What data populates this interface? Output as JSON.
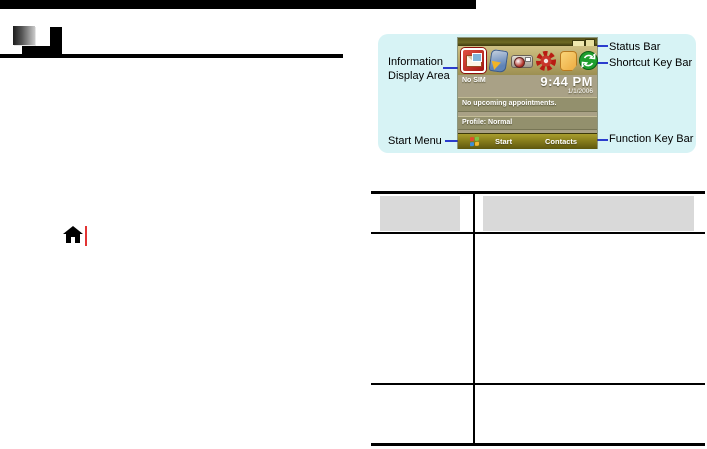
{
  "annotations": {
    "left": [
      {
        "text": "Information Display Area"
      },
      {
        "text": "Start Menu"
      }
    ],
    "right": [
      {
        "text": "Status Bar"
      },
      {
        "text": "Shortcut Key Bar"
      },
      {
        "text": "Function Key Bar"
      }
    ]
  },
  "phone": {
    "status_icons": [
      "battery-icon",
      "sim-icon"
    ],
    "shortcut_icons": [
      "messaging-icon",
      "phone-icon",
      "camera-icon",
      "settings-icon",
      "notes-icon",
      "activesync-icon"
    ],
    "no_sim": "No SIM",
    "time": "9:44 PM",
    "date": "1/1/2006",
    "appointments": "No upcoming appointments.",
    "profile": "Profile: Normal",
    "softkeys": {
      "left": "Start",
      "right": "Contacts"
    }
  },
  "table": {
    "columns": 2,
    "header_cells": [
      "",
      ""
    ],
    "body_rows": [
      [
        "",
        ""
      ],
      [
        "",
        ""
      ]
    ]
  },
  "colors": {
    "panel_bg": "#d7f3f5",
    "connector_blue": "#2b3cce",
    "table_header_gray": "#d9d9d9",
    "page_rule_black": "#000000"
  }
}
